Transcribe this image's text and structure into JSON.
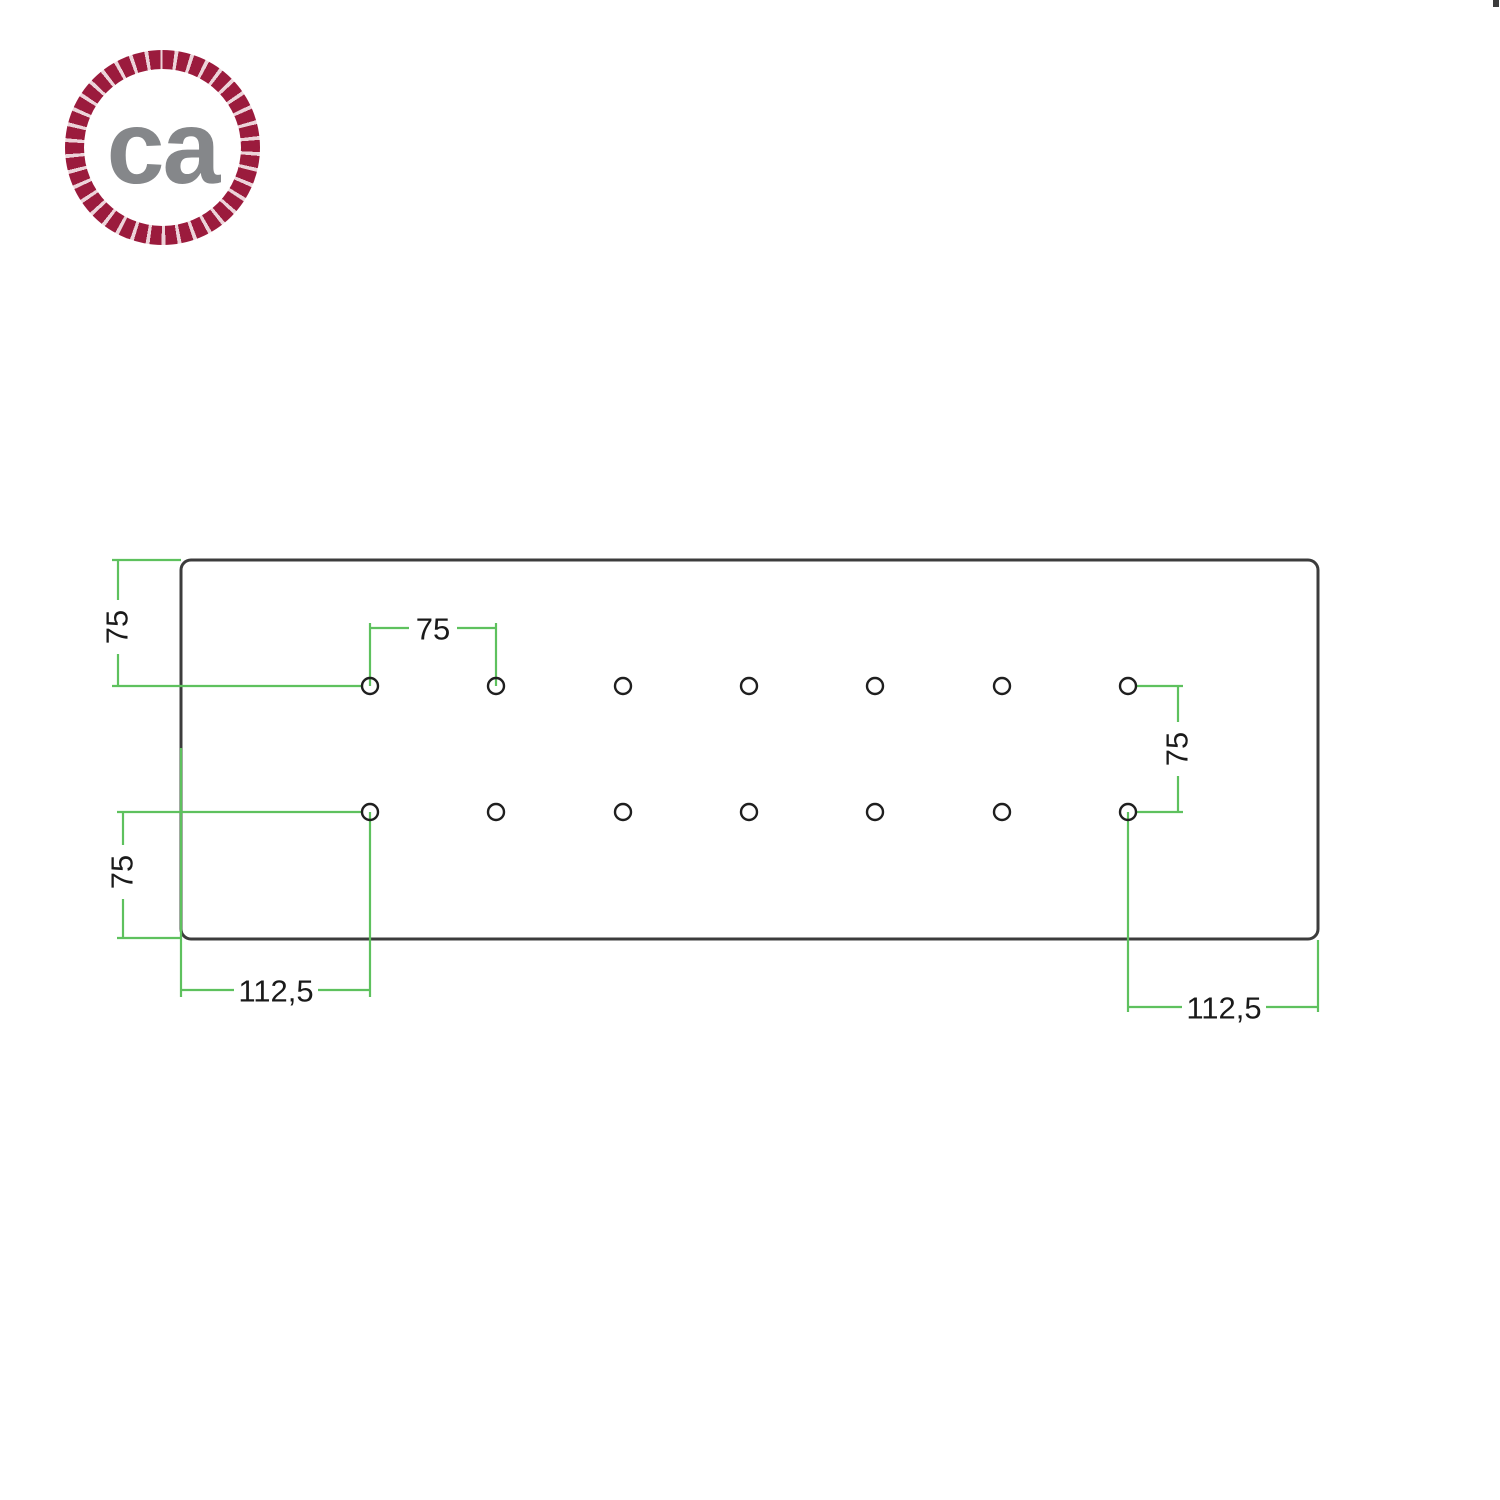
{
  "logo": {
    "text": "ca",
    "text_color": "#85878a",
    "rope_color": "#9b1b3d"
  },
  "drawing": {
    "outline_color": "#3c3c3c",
    "hole_color": "#1f1f1f",
    "dimension_line_color": "#5ec15e",
    "dimension_text_color": "#1a1a1a",
    "plate": {
      "shape": "rounded-rectangle",
      "hole_rows": 2,
      "hole_columns": 7,
      "hole_count": 14
    },
    "labels": {
      "top_left_vertical": "75",
      "top_hole_spacing": "75",
      "right_vertical": "75",
      "bottom_left_vertical": "75",
      "bottom_left_offset": "112,5",
      "bottom_right_offset": "112,5"
    }
  }
}
